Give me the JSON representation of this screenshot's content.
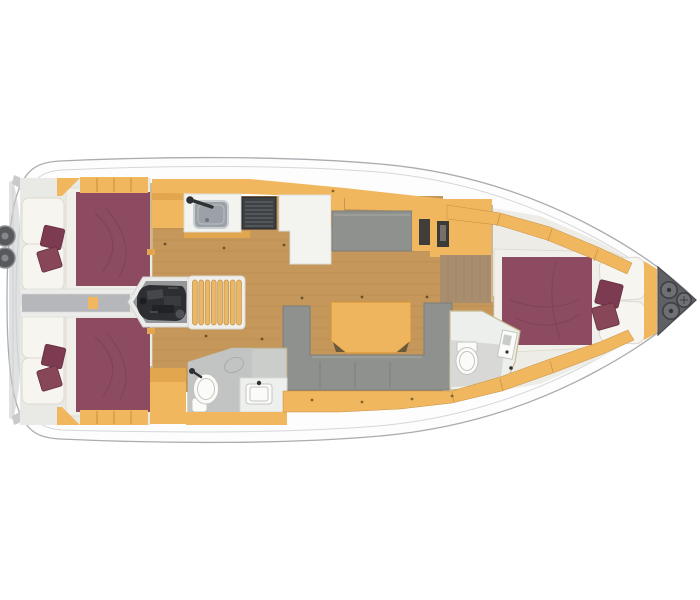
{
  "meta": {
    "title": "Sailing yacht interior layout floor plan, top-down view, bow pointing right",
    "view": "top-down",
    "bow_direction": "right"
  },
  "palette": {
    "hull_stroke": "#a9adb0",
    "deck_line": "#d5d7d8",
    "stern_gray": "#c9cacc",
    "corridor_gray": "#b6b7ba",
    "wood_cabinet": "#f0b75f",
    "wood_cabinet_dark": "#e2a64e",
    "wood_cabinet_line": "#c68f42",
    "wood_floor": "#c6975a",
    "plank_line": "#b0814a",
    "berth": "#8d4b61",
    "berth_fold": "#7a3d52",
    "pillow_dark": "#7c3b50",
    "pillow_mid": "#884659",
    "cushion": "#f6f5ef",
    "cushion_edge": "#dcd9cf",
    "mattress_base": "#f0efe9",
    "sofa": "#8f918e",
    "sofa_edge": "#7b7d79",
    "table": "#efb45e",
    "table_edge": "#d2973f",
    "stove": "#3e4144",
    "sink": "#9aa1a7",
    "engine": "#2d2e31",
    "engine_bay": "#95969a",
    "stairs": "#e9b765",
    "stairs_line": "#c08f45",
    "heads_floor": "#cbcdcb",
    "fixture_white": "#fbfbf9",
    "fixture_stroke": "#c5c5bf",
    "wall": "#cfb88c",
    "laminate": "#a98e6d",
    "locker_gray": "#5f6065",
    "locker_circle": "#6e7074"
  },
  "rooms": [
    {
      "id": "aft-cabin-port",
      "label": "Aft cabin (port) with double berth"
    },
    {
      "id": "aft-cabin-starboard",
      "label": "Aft cabin (starboard) with double berth"
    },
    {
      "id": "engine-compartment",
      "label": "Engine compartment"
    },
    {
      "id": "companionway",
      "label": "Companionway steps"
    },
    {
      "id": "galley",
      "label": "Galley with sink and stove"
    },
    {
      "id": "salon",
      "label": "Salon with U-sofa, table and side settee"
    },
    {
      "id": "heads-aft",
      "label": "Aft heads with toilet, sink and shower"
    },
    {
      "id": "heads-forward",
      "label": "Forward heads with toilet and shower"
    },
    {
      "id": "forward-cabin",
      "label": "Forward cabin with double berth"
    },
    {
      "id": "anchor-locker",
      "label": "Bow anchor locker"
    }
  ]
}
